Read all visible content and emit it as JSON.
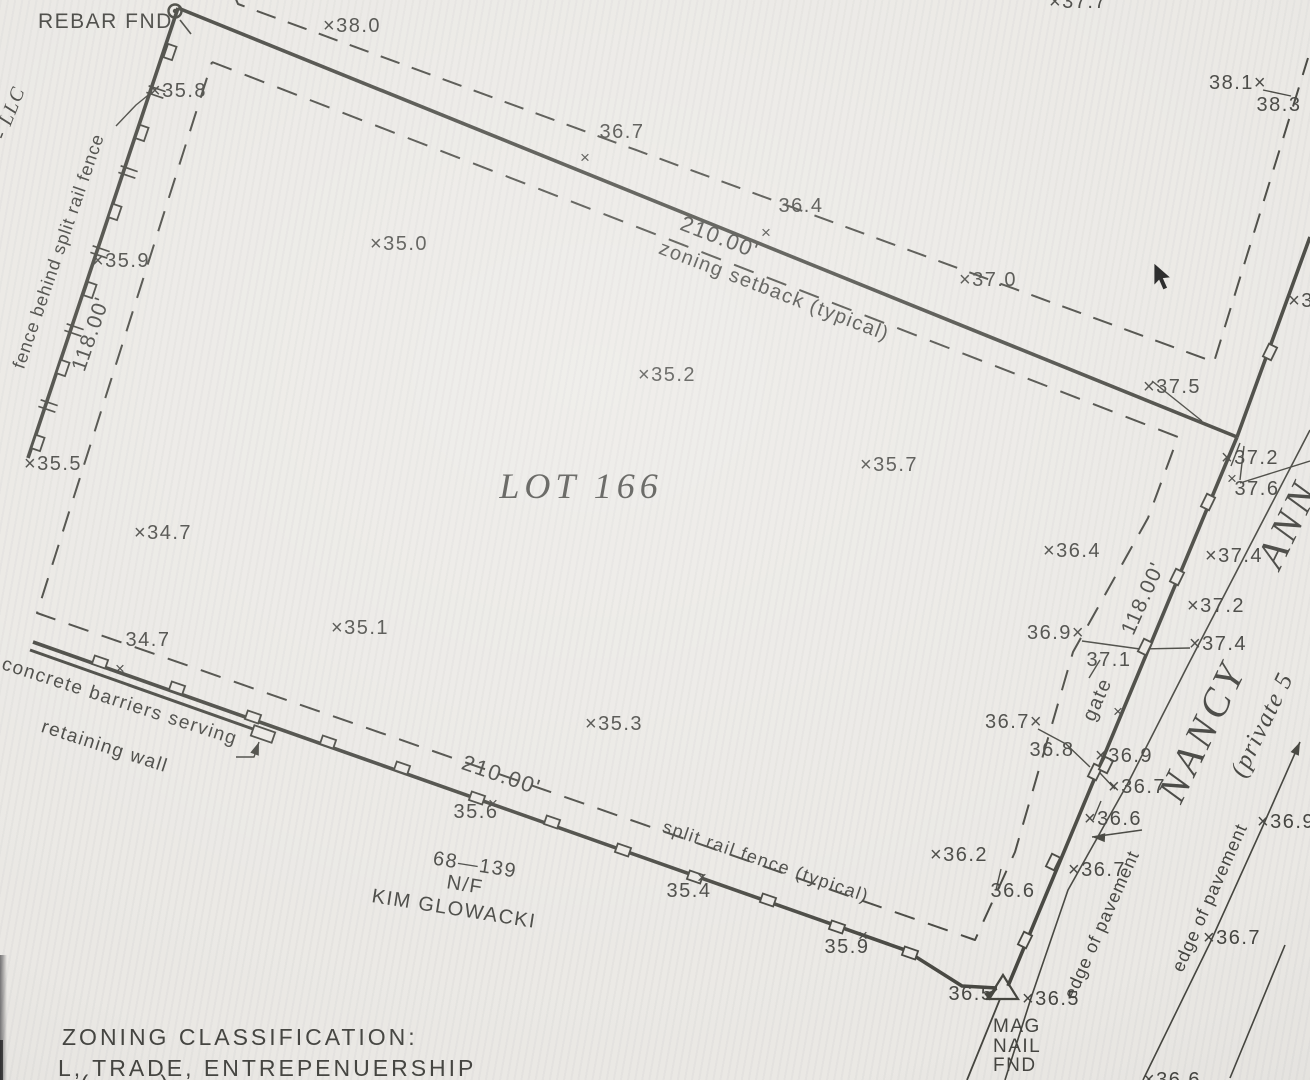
{
  "drawing": {
    "paper_color": "#eae8e4",
    "ink_color": "#45453f",
    "cursor_color": "#191919",
    "lot_title": "LOT 166",
    "lines": [
      {
        "name": "top-boundary-line",
        "w": 3.6,
        "pts": [
          [
            178,
            8
          ],
          [
            1237,
            437
          ]
        ]
      },
      {
        "name": "left-fence-line",
        "w": 3.6,
        "pts": [
          [
            178,
            8
          ],
          [
            28,
            458
          ]
        ]
      },
      {
        "name": "bottom-fence-line",
        "w": 3.6,
        "pts": [
          [
            33,
            642
          ],
          [
            905,
            950
          ],
          [
            962,
            986
          ],
          [
            997,
            988
          ]
        ]
      },
      {
        "name": "right-boundary-line",
        "w": 3.6,
        "pts": [
          [
            1237,
            437
          ],
          [
            1008,
            986
          ]
        ]
      },
      {
        "name": "road-fence-north-line",
        "w": 3.6,
        "pts": [
          [
            1310,
            237
          ],
          [
            1237,
            437
          ]
        ]
      },
      {
        "name": "outer-setback-dashed-line",
        "w": 2,
        "dash": "20 13",
        "pts": [
          [
            233,
            -8
          ],
          [
            238,
            4
          ],
          [
            1214,
            362
          ],
          [
            1308,
            58
          ]
        ]
      },
      {
        "name": "zoning-setback-dashed-line",
        "w": 2,
        "dash": "21 14",
        "pts": [
          [
            212,
            62
          ],
          [
            1178,
            437
          ],
          [
            1148,
            518
          ],
          [
            1073,
            652
          ],
          [
            1015,
            852
          ],
          [
            975,
            940
          ],
          [
            37,
            613
          ],
          [
            212,
            62
          ]
        ]
      },
      {
        "name": "pavement-west-edge-line",
        "w": 1.6,
        "pts": [
          [
            1310,
            430
          ],
          [
            1188,
            665
          ],
          [
            1128,
            783
          ],
          [
            1068,
            890
          ],
          [
            1032,
            995
          ],
          [
            1005,
            1080
          ]
        ]
      },
      {
        "name": "pavement-east-edge-line",
        "w": 1.6,
        "pts": [
          [
            1300,
            742
          ],
          [
            1262,
            828
          ],
          [
            1210,
            943
          ],
          [
            1143,
            1080
          ]
        ]
      },
      {
        "name": "road-line-southeast",
        "w": 1.6,
        "pts": [
          [
            1285,
            945
          ],
          [
            1230,
            1078
          ]
        ]
      },
      {
        "name": "lot-line-south",
        "w": 1.8,
        "pts": [
          [
            1000,
            999
          ],
          [
            967,
            1080
          ]
        ]
      },
      {
        "name": "northeast-road-line",
        "w": 1.4,
        "pts": [
          [
            1240,
            483
          ],
          [
            1310,
            461
          ]
        ]
      },
      {
        "name": "concrete-barrier-line",
        "w": 3,
        "pts": [
          [
            30,
            650
          ],
          [
            253,
            729
          ]
        ]
      },
      {
        "name": "leader-35-8",
        "w": 1.4,
        "pts": [
          [
            152,
            92
          ],
          [
            136,
            105
          ],
          [
            116,
            126
          ]
        ]
      },
      {
        "name": "leader-38-1",
        "w": 1.4,
        "pts": [
          [
            1263,
            90
          ],
          [
            1291,
            96
          ]
        ]
      },
      {
        "name": "leader-37-5",
        "w": 1.4,
        "pts": [
          [
            1152,
            381
          ],
          [
            1202,
            421
          ]
        ]
      },
      {
        "name": "leader-37-2",
        "w": 1.4,
        "pts": [
          [
            1231,
            466
          ],
          [
            1240,
            443
          ]
        ]
      },
      {
        "name": "leader-37-6",
        "w": 1.4,
        "pts": [
          [
            1240,
            480
          ],
          [
            1244,
            446
          ]
        ]
      },
      {
        "name": "leader-36-9-37-4",
        "w": 1.4,
        "pts": [
          [
            1082,
            641
          ],
          [
            1140,
            649
          ],
          [
            1190,
            648
          ]
        ]
      },
      {
        "name": "leader-37-1",
        "w": 1.4,
        "pts": [
          [
            1100,
            660
          ],
          [
            1089,
            678
          ]
        ]
      },
      {
        "name": "leader-36-7-36-8",
        "w": 1.4,
        "pts": [
          [
            1038,
            729
          ],
          [
            1066,
            744
          ],
          [
            1090,
            767
          ]
        ]
      },
      {
        "name": "leader-36-7-lower",
        "w": 1.4,
        "pts": [
          [
            1115,
            789
          ],
          [
            1100,
            773
          ]
        ]
      },
      {
        "name": "leader-36-6-lower",
        "w": 1.4,
        "pts": [
          [
            1093,
            820
          ],
          [
            1101,
            801
          ]
        ]
      },
      {
        "name": "leader-edge-of-pavement",
        "w": 1.4,
        "pts": [
          [
            1092,
            837
          ],
          [
            1142,
            830
          ]
        ]
      },
      {
        "name": "leader-36-6-mid",
        "w": 1.4,
        "pts": [
          [
            996,
            890
          ],
          [
            1001,
            869
          ]
        ]
      },
      {
        "name": "leader-36-5",
        "w": 1.4,
        "pts": [
          [
            986,
            999
          ],
          [
            997,
            989
          ]
        ]
      },
      {
        "name": "leader-barrier-label",
        "w": 1.4,
        "pts": [
          [
            236,
            757
          ],
          [
            254,
            757
          ],
          [
            259,
            742
          ]
        ]
      },
      {
        "name": "rebar-tick",
        "w": 1.6,
        "pts": [
          [
            180,
            20
          ],
          [
            191,
            34
          ]
        ]
      }
    ],
    "fence_posts": [
      {
        "x": 170,
        "y": 52,
        "a": -71
      },
      {
        "x": 142,
        "y": 133,
        "a": -71
      },
      {
        "x": 115,
        "y": 212,
        "a": -71
      },
      {
        "x": 90,
        "y": 290,
        "a": -71
      },
      {
        "x": 63,
        "y": 368,
        "a": -71
      },
      {
        "x": 38,
        "y": 443,
        "a": -71
      },
      {
        "x": 100,
        "y": 662,
        "a": 19
      },
      {
        "x": 177,
        "y": 688,
        "a": 19
      },
      {
        "x": 253,
        "y": 717,
        "a": 19
      },
      {
        "x": 328,
        "y": 742,
        "a": 19
      },
      {
        "x": 402,
        "y": 768,
        "a": 19
      },
      {
        "x": 477,
        "y": 798,
        "a": 19
      },
      {
        "x": 552,
        "y": 822,
        "a": 19
      },
      {
        "x": 623,
        "y": 850,
        "a": 19
      },
      {
        "x": 695,
        "y": 877,
        "a": 19
      },
      {
        "x": 768,
        "y": 900,
        "a": 19
      },
      {
        "x": 837,
        "y": 927,
        "a": 19
      },
      {
        "x": 910,
        "y": 953,
        "a": 19
      },
      {
        "x": 1208,
        "y": 502,
        "a": -64
      },
      {
        "x": 1177,
        "y": 577,
        "a": -64
      },
      {
        "x": 1145,
        "y": 647,
        "a": -64
      },
      {
        "x": 1095,
        "y": 772,
        "a": -64
      },
      {
        "x": 1106,
        "y": 765,
        "a": -64
      },
      {
        "x": 1053,
        "y": 862,
        "a": -64
      },
      {
        "x": 1025,
        "y": 940,
        "a": -64
      },
      {
        "x": 1270,
        "y": 352,
        "a": -64
      },
      {
        "x": 263,
        "y": 734,
        "a": 19,
        "w": 22,
        "h": 11
      }
    ],
    "rail_ticks": [
      {
        "x": 156,
        "y": 92,
        "a": 19
      },
      {
        "x": 128,
        "y": 172,
        "a": 19
      },
      {
        "x": 100,
        "y": 252,
        "a": 19
      },
      {
        "x": 74,
        "y": 330,
        "a": 19
      },
      {
        "x": 48,
        "y": 406,
        "a": 19
      }
    ],
    "x_marks": [
      {
        "x": 585,
        "y": 157
      },
      {
        "x": 766,
        "y": 232
      },
      {
        "x": 1232,
        "y": 478
      },
      {
        "x": 493,
        "y": 803
      },
      {
        "x": 702,
        "y": 877
      },
      {
        "x": 863,
        "y": 935
      },
      {
        "x": 1118,
        "y": 711
      },
      {
        "x": 120,
        "y": 668
      }
    ],
    "arrows": [
      {
        "x": 1300,
        "y": 742,
        "a": -66
      },
      {
        "x": 1092,
        "y": 837,
        "a": 183
      },
      {
        "x": 997,
        "y": 989,
        "a": -38
      },
      {
        "x": 259,
        "y": 742,
        "a": -70
      }
    ],
    "symbols": {
      "rebar": {
        "x": 175,
        "y": 11
      },
      "mag_nail": {
        "pts": [
          [
            1003,
            975
          ],
          [
            988,
            999
          ],
          [
            1018,
            999
          ]
        ]
      },
      "cursor": {
        "x": 1154,
        "y": 263
      }
    },
    "labels": [
      {
        "name": "rebar-fnd-label",
        "t": "REBAR FND",
        "x": 38,
        "y": 28,
        "s": 21,
        "anchor": "start"
      },
      {
        "name": "spot-elevation",
        "t": "×38.0",
        "x": 352,
        "y": 32
      },
      {
        "name": "spot-elevation-clipped",
        "t": "×37.7",
        "x": 1078,
        "y": 8
      },
      {
        "name": "spot-elevation",
        "t": "38.1×",
        "x": 1238,
        "y": 89
      },
      {
        "name": "spot-elevation",
        "t": "38.3",
        "x": 1279,
        "y": 111
      },
      {
        "name": "spot-elevation",
        "t": "×35.8",
        "x": 178,
        "y": 97
      },
      {
        "name": "spot-elevation",
        "t": "36.7",
        "x": 622,
        "y": 138
      },
      {
        "name": "spot-elevation",
        "t": "36.4",
        "x": 801,
        "y": 212
      },
      {
        "name": "spot-elevation",
        "t": "×37.0",
        "x": 988,
        "y": 286
      },
      {
        "name": "spot-elevation",
        "t": "×35.0",
        "x": 399,
        "y": 250
      },
      {
        "name": "spot-elevation",
        "t": "×35.2",
        "x": 667,
        "y": 381
      },
      {
        "name": "spot-elevation",
        "t": "×37.5",
        "x": 1172,
        "y": 393
      },
      {
        "name": "spot-elevation",
        "t": "×35.7",
        "x": 889,
        "y": 471
      },
      {
        "name": "spot-elevation",
        "t": "×37.2",
        "x": 1250,
        "y": 464
      },
      {
        "name": "spot-elevation",
        "t": "37.6",
        "x": 1257,
        "y": 495
      },
      {
        "name": "spot-elevation",
        "t": "×36.4",
        "x": 1072,
        "y": 557
      },
      {
        "name": "spot-elevation",
        "t": "×37.4",
        "x": 1234,
        "y": 562
      },
      {
        "name": "spot-elevation",
        "t": "×37.2",
        "x": 1216,
        "y": 612
      },
      {
        "name": "spot-elevation",
        "t": "×37.4",
        "x": 1218,
        "y": 650
      },
      {
        "name": "dimension-right",
        "t": "118.00'",
        "x": 1149,
        "y": 601,
        "r": -66,
        "s": 21
      },
      {
        "name": "spot-elevation",
        "t": "36.9×",
        "x": 1056,
        "y": 639
      },
      {
        "name": "spot-elevation",
        "t": "37.1",
        "x": 1109,
        "y": 666
      },
      {
        "name": "gate-label",
        "t": "gate",
        "x": 1103,
        "y": 702,
        "r": -66
      },
      {
        "name": "spot-elevation",
        "t": "×36.9",
        "x": 1124,
        "y": 762
      },
      {
        "name": "spot-elevation",
        "t": "36.7×",
        "x": 1014,
        "y": 728
      },
      {
        "name": "spot-elevation",
        "t": "36.8",
        "x": 1052,
        "y": 756
      },
      {
        "name": "spot-elevation",
        "t": "×36.7",
        "x": 1137,
        "y": 793
      },
      {
        "name": "spot-elevation",
        "t": "×36.6",
        "x": 1113,
        "y": 825
      },
      {
        "name": "spot-elevation",
        "t": "×36.9",
        "x": 1286,
        "y": 828
      },
      {
        "name": "spot-elevation",
        "t": "×35.1",
        "x": 360,
        "y": 634
      },
      {
        "name": "spot-elevation",
        "t": "×34.7",
        "x": 163,
        "y": 539
      },
      {
        "name": "spot-elevation",
        "t": "34.7",
        "x": 148,
        "y": 646
      },
      {
        "name": "spot-elevation",
        "t": "×35.3",
        "x": 614,
        "y": 730
      },
      {
        "name": "spot-elevation",
        "t": "×35.5",
        "x": 53,
        "y": 470
      },
      {
        "name": "spot-elevation",
        "t": "×35.9",
        "x": 121,
        "y": 267
      },
      {
        "name": "spot-elevation",
        "t": "35.6",
        "x": 476,
        "y": 818
      },
      {
        "name": "spot-elevation",
        "t": "35.4",
        "x": 689,
        "y": 897
      },
      {
        "name": "spot-elevation",
        "t": "35.9",
        "x": 847,
        "y": 953
      },
      {
        "name": "spot-elevation",
        "t": "×36.2",
        "x": 959,
        "y": 861
      },
      {
        "name": "spot-elevation",
        "t": "36.6",
        "x": 1013,
        "y": 897
      },
      {
        "name": "spot-elevation",
        "t": "×36.7",
        "x": 1097,
        "y": 876
      },
      {
        "name": "spot-elevation",
        "t": "36.5",
        "x": 971,
        "y": 1000
      },
      {
        "name": "spot-elevation",
        "t": "×36.5",
        "x": 1051,
        "y": 1005
      },
      {
        "name": "spot-elevation",
        "t": "×36.7",
        "x": 1232,
        "y": 944
      },
      {
        "name": "spot-elevation-clipped",
        "t": "×36.6",
        "x": 1172,
        "y": 1086
      },
      {
        "name": "spot-elevation-clipped",
        "t": "×3",
        "x": 1301,
        "y": 307
      },
      {
        "name": "mag-nail-label-1",
        "t": "MAG",
        "x": 993,
        "y": 1032,
        "s": 19,
        "anchor": "start"
      },
      {
        "name": "mag-nail-label-2",
        "t": "NAIL",
        "x": 993,
        "y": 1052,
        "s": 19,
        "anchor": "start"
      },
      {
        "name": "mag-nail-label-3",
        "t": "FND",
        "x": 993,
        "y": 1071,
        "s": 19,
        "anchor": "start"
      },
      {
        "name": "owner-llc-label",
        "t": "- LLC",
        "x": 15,
        "y": 115,
        "r": -68,
        "f": "serifI",
        "s": 20
      },
      {
        "name": "fence-note-label",
        "t": "fence behind split rail fence",
        "x": 64,
        "y": 253,
        "r": -71,
        "s": 18,
        "ls": 1
      },
      {
        "name": "dimension-left",
        "t": "118.00'",
        "x": 97,
        "y": 336,
        "r": -71,
        "s": 21
      },
      {
        "name": "dimension-top",
        "t": "210.00'",
        "x": 717,
        "y": 244,
        "r": 21,
        "s": 22
      },
      {
        "name": "zoning-setback-label",
        "t": "zoning setback (typical)",
        "x": 772,
        "y": 297,
        "r": 21,
        "s": 20
      },
      {
        "name": "lot-title",
        "t": "LOT 166",
        "x": 581,
        "y": 498,
        "f": "serifI",
        "s": 36,
        "ls": 5
      },
      {
        "name": "dimension-bottom",
        "t": "210.00'",
        "x": 499,
        "y": 782,
        "r": 19,
        "s": 22
      },
      {
        "name": "split-rail-fence-label",
        "t": "split rail fence (typical)",
        "x": 764,
        "y": 867,
        "r": 19,
        "s": 18
      },
      {
        "name": "parcel-number-label",
        "t": "68—139",
        "x": 474,
        "y": 871,
        "r": 9
      },
      {
        "name": "parcel-nf-label",
        "t": "N/F",
        "x": 464,
        "y": 891,
        "r": 9
      },
      {
        "name": "parcel-owner-label",
        "t": "KIM GLOWACKI",
        "x": 453,
        "y": 915,
        "r": 9
      },
      {
        "name": "barrier-note-line1",
        "t": "concrete barriers serving",
        "x": 118,
        "y": 707,
        "r": 18,
        "s": 19
      },
      {
        "name": "barrier-note-line2",
        "t": "retaining wall",
        "x": 103,
        "y": 752,
        "r": 18,
        "s": 19
      },
      {
        "name": "zoning-classification-title",
        "t": "ZONING CLASSIFICATION:",
        "x": 62,
        "y": 1045,
        "s": 23,
        "ls": 3,
        "anchor": "start"
      },
      {
        "name": "zoning-classification-value",
        "t": "L, TRADE, ENTREPENUERSHIP",
        "x": 58,
        "y": 1076,
        "s": 23,
        "ls": 3,
        "anchor": "start"
      },
      {
        "name": "road-name-nancy",
        "t": "NANCY",
        "x": 1214,
        "y": 737,
        "r": -64,
        "f": "serifI",
        "s": 40,
        "ls": 5
      },
      {
        "name": "road-name-ann",
        "t": "ANN",
        "x": 1300,
        "y": 529,
        "r": -64,
        "f": "serifI",
        "s": 40,
        "ls": 5
      },
      {
        "name": "road-private-label",
        "t": "(private 5",
        "x": 1269,
        "y": 728,
        "r": -64,
        "f": "serifI",
        "s": 25
      },
      {
        "name": "edge-of-pavement-west",
        "t": "edge of pavement",
        "x": 1107,
        "y": 927,
        "r": -66,
        "s": 18,
        "ls": 1
      },
      {
        "name": "edge-of-pavement-east",
        "t": "edge of pavement",
        "x": 1215,
        "y": 900,
        "r": -66,
        "s": 18,
        "ls": 1
      },
      {
        "name": "clipped-paren-left",
        "t": "(",
        "x": 85,
        "y": 1092,
        "s": 24
      },
      {
        "name": "clipped-paren-right",
        "t": ")",
        "x": 165,
        "y": 1092,
        "s": 24
      }
    ]
  }
}
